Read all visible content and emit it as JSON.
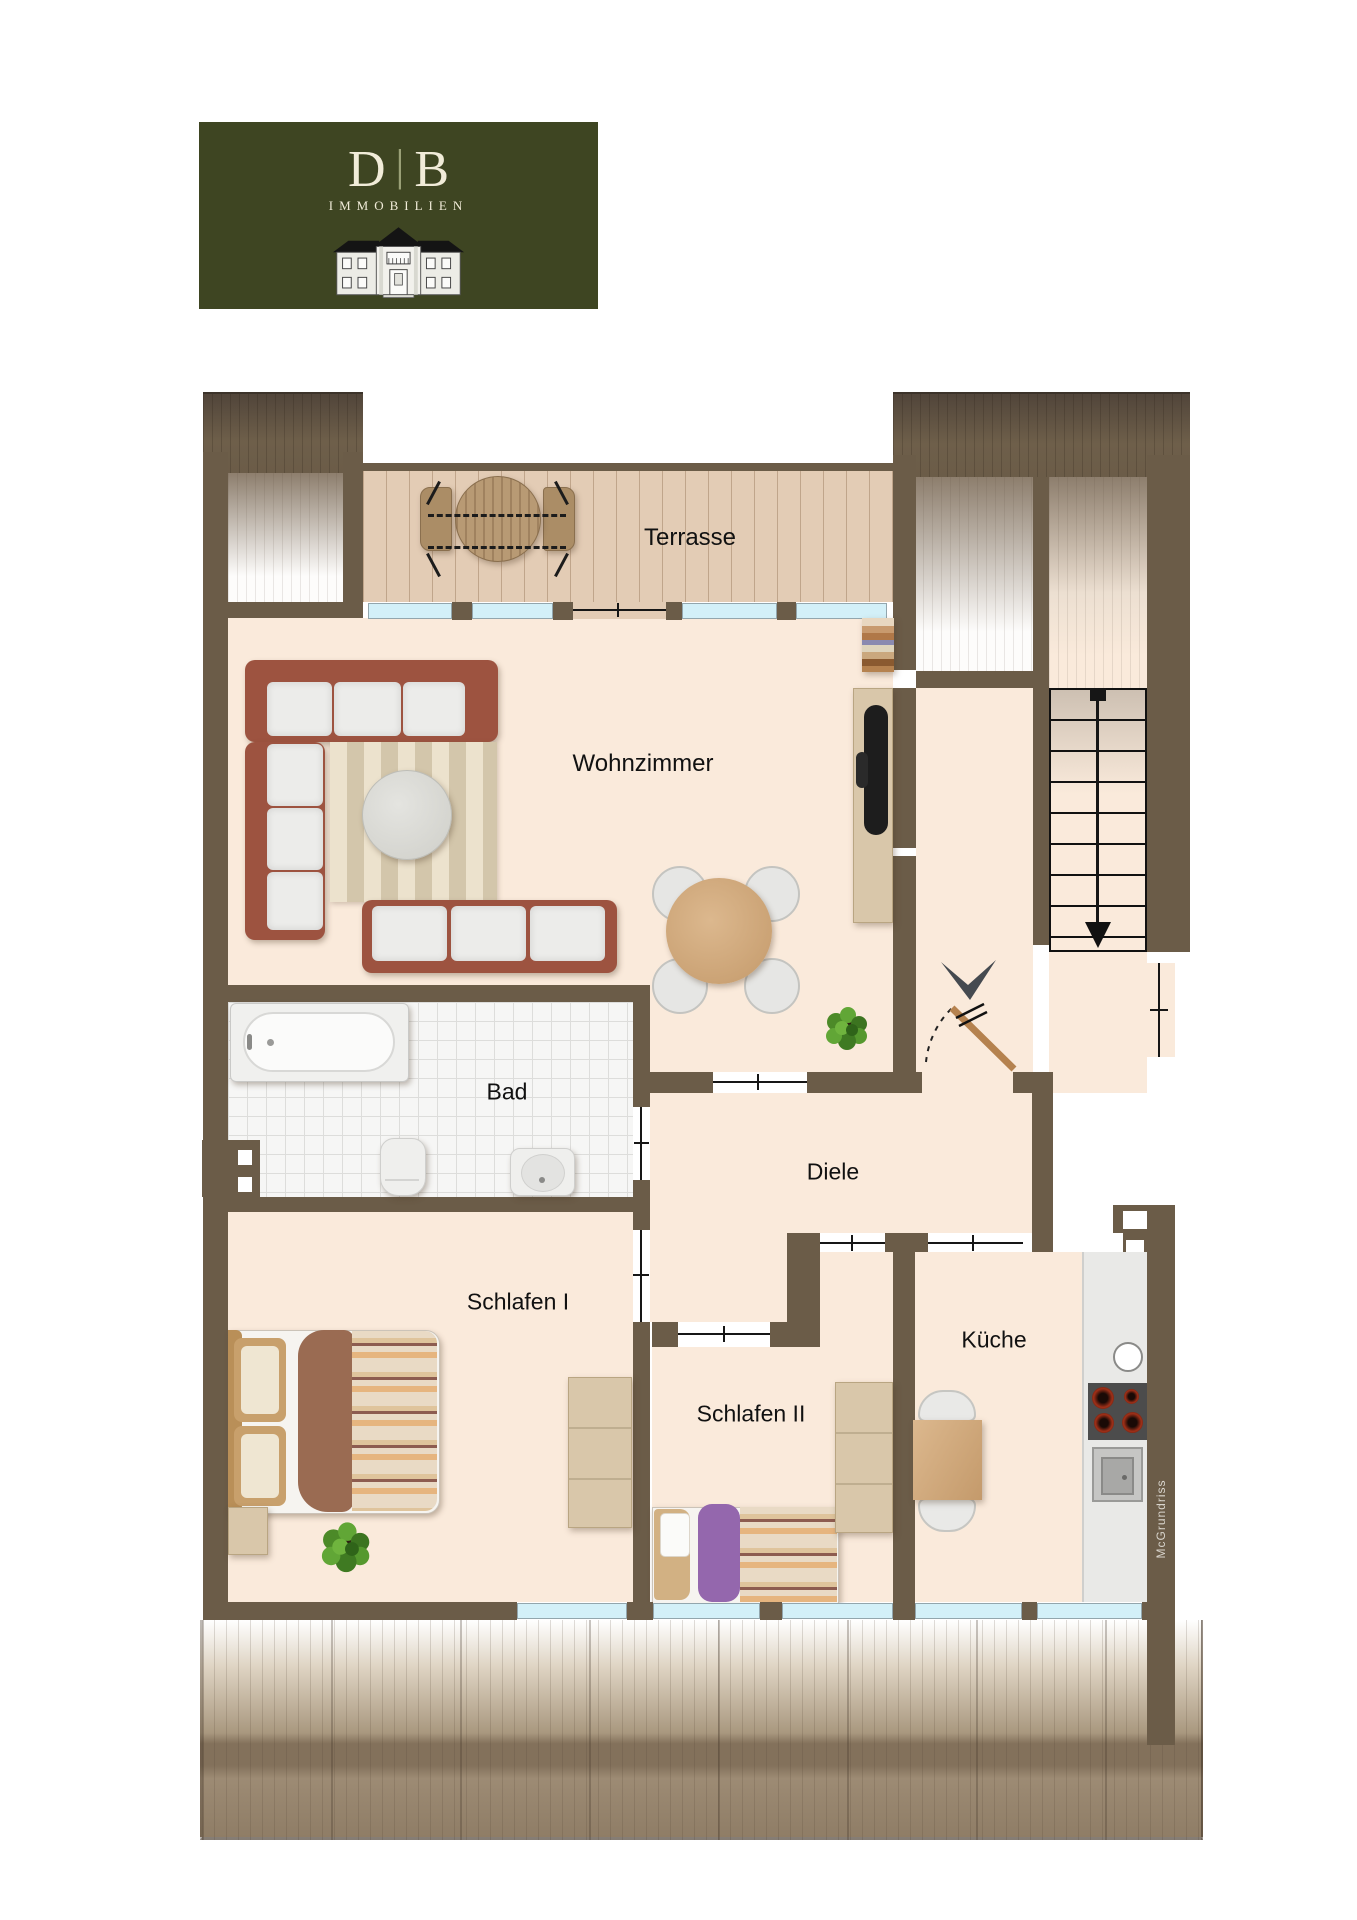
{
  "logo": {
    "letter_left": "D",
    "divider": "|",
    "letter_right": "B",
    "subtitle": "IMMOBILIEN"
  },
  "rooms": {
    "terrasse": "Terrasse",
    "wohnzimmer": "Wohnzimmer",
    "bad": "Bad",
    "diele": "Diele",
    "schlafen1": "Schlafen I",
    "schlafen2": "Schlafen II",
    "kueche": "Küche"
  },
  "watermark": "McGrundriss",
  "colors": {
    "logo_green": "#3E4522",
    "wall_brown": "#6B5C48",
    "floor_cream": "#FAEADB",
    "window_blue": "#D3F0F8",
    "roof_brown": "#8D7D69",
    "sofa_terracotta": "#9D5340",
    "door_wood": "#B5824F",
    "bed_purple": "#9467AD"
  }
}
